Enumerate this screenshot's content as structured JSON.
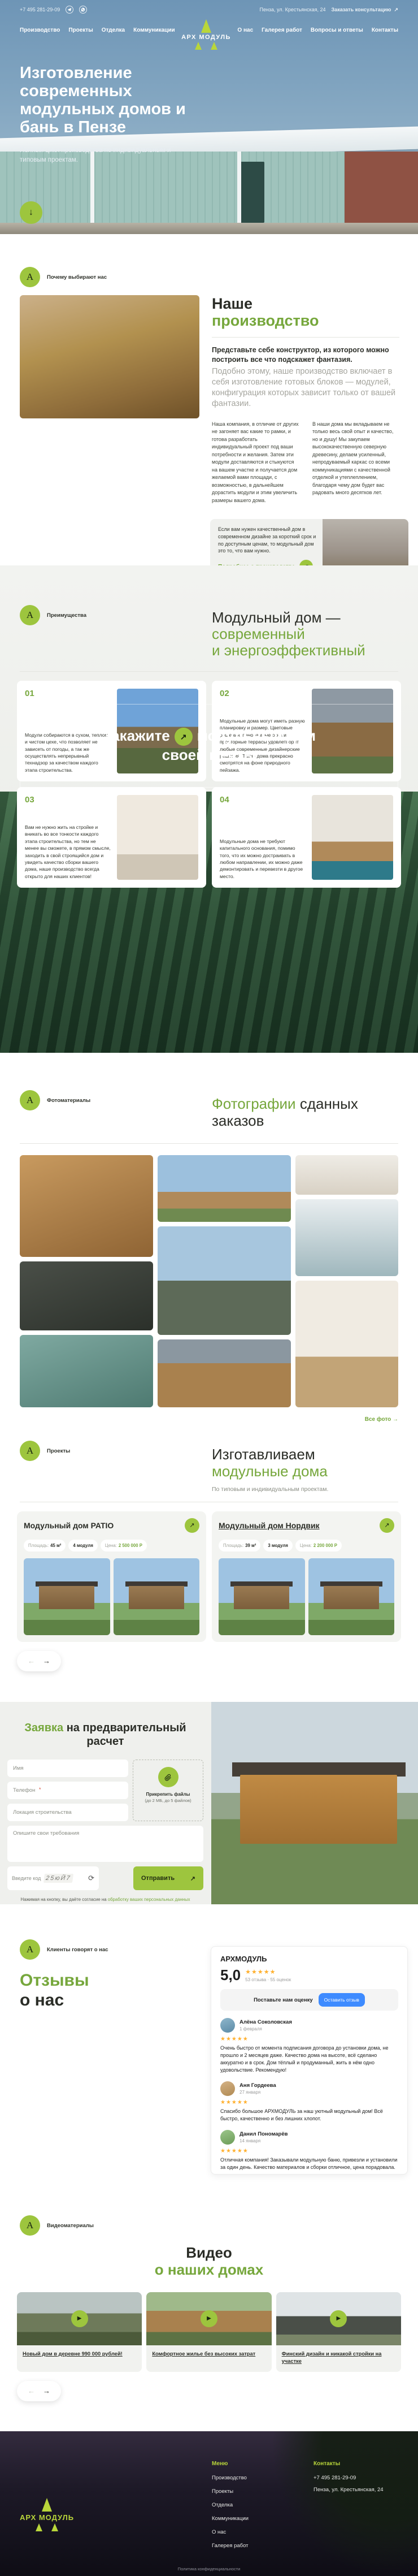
{
  "brand": {
    "name": "АРХ МОДУЛЬ",
    "mark": "А"
  },
  "icons": {
    "arrow_down": "↓",
    "arrow_up_right": "↗",
    "arrow_left": "←",
    "arrow_right": "→",
    "refresh": "⟳",
    "play": "▶"
  },
  "topbar": {
    "phone": "+7 495 281-29-09",
    "address": "Пенза, ул. Крестьянская, 24",
    "consult": "Заказать консультацию"
  },
  "nav": {
    "left": [
      {
        "label": "Производство"
      },
      {
        "label": "Проекты"
      },
      {
        "label": "Отделка"
      },
      {
        "label": "Коммуникации"
      }
    ],
    "right": [
      {
        "label": "О нас"
      },
      {
        "label": "Галерея работ"
      },
      {
        "label": "Вопросы и ответы"
      },
      {
        "label": "Контакты"
      }
    ]
  },
  "hero": {
    "title": "Изготовление современных модульных домов и бань в Пензе",
    "subtitle": "Полный цикл производства по индивидуальным и типовым проектам."
  },
  "production": {
    "label": "Почему выбирают нас",
    "heading_dark": "Наше",
    "heading_green": "производство",
    "lead_bold": "Представьте себе конструктор, из которого можно построить все что подскажет фантазия.",
    "lead_gray": "Подобно этому, наше производство включает в себя изготовление готовых блоков — модулей, конфигурация которых зависит только от вашей фантазии.",
    "col1": "Наша компания, в отличие от других не загоняет вас какие то рамки, и готова разработать индивидуальный проект под ваши потребности и желания. Затем эти модули доставляются и стыкуются на вашем участке и получается дом желаемой вами площади, с возможностью, в дальнейшем дорастить модули и этим увеличить размеры вашего дома.",
    "col2": "В наши дома мы вкладываем не только весь свой опыт и качество, но и душу! Мы закупаем высококачественную северную древесину, делаем усиленный, непродуваемый каркас со всеми коммуникациями с качественной отделкой и утеплеплением, благодаря чему дом будет вас радовать много десятков лет.",
    "card_text": "Если вам нужен качественный дом в современном дизайне за короткий срок и по доступным ценам, то модульный дом это то, что вам нужно.",
    "card_link": "Подробнее о производстве"
  },
  "advantages": {
    "label": "Преимущества",
    "heading_dark": "Модульный дом —",
    "heading_green_1": "современный",
    "heading_green_2": "и энергоэффективный",
    "items": [
      {
        "num": "01",
        "text": "Модули собираются в сухом, теплом и чистом цехе, что позволяет не зависеть от погоды, а так же осуществлять непрерывный технадзор за качеством каждого этапа строительства."
      },
      {
        "num": "02",
        "text": "Модульные дома могут иметь разную планировку и размер. Цветовые решения, панорамные окна и просторные террасы удовлетворят любые современные дизайнерские решения. Такие дома прекрасно смотрятся на фоне природного пейзажа."
      },
      {
        "num": "03",
        "text": "Вам не нужно жить на стройке и вникать во все тонкости каждого этапа строительства, но тем не менее вы сможете, в прямом смысле, заходить в свой строящийся дом и увидеть качество сборки вашего дома, наше производство всегда открыто для наших клиентов!"
      },
      {
        "num": "04",
        "text": "Модульные дома не требуют капитального основания, помимо того, что их можно достраивать в любом направлении, их можно даже демонтировать и перевезти в другое место."
      }
    ]
  },
  "banner": {
    "text_1": "Закажите",
    "text_2": "модульный дом своей мечты"
  },
  "gallery": {
    "label": "Фотоматериалы",
    "heading_green": "Фотографии",
    "heading_dark": "сданных заказов",
    "link": "Все фото"
  },
  "projects": {
    "label": "Проекты",
    "heading_dark": "Изготавливаем",
    "heading_green": "модульные дома",
    "subtitle": "По типовым и индивидуальным проектам.",
    "area_label": "Площадь:",
    "price_label": "Цена:",
    "cards": [
      {
        "title": "Модульный дом PATIO",
        "area": "45 м²",
        "modules": "4 модуля",
        "price": "2 500 000 Р"
      },
      {
        "title": "Модульный дом Нордвик",
        "area": "39 м²",
        "modules": "3 модуля",
        "price": "2 200 000 Р"
      }
    ]
  },
  "form": {
    "heading_green": "Заявка",
    "heading_dark": "на предварительный расчет",
    "name_placeholder": "Имя",
    "phone_placeholder": "Телефон",
    "phone_required_mark": "*",
    "location_placeholder": "Локация строительства",
    "message_placeholder": "Опишите свои требования",
    "captcha_label": "Введите код",
    "captcha_value": "25юЙ7",
    "attach_line1": "Прикрепить файлы",
    "attach_line2": "(до 2 МБ, до 5 файлов)",
    "submit": "Отправить",
    "consent_text": "Нажимая на кнопку, вы даёте согласие на",
    "consent_link": "обработку ваших персональных данных"
  },
  "reviews": {
    "label": "Клиенты говорят о нас",
    "heading_green": "Отзывы",
    "heading_dark": "о нас",
    "widget": {
      "org": "АРХМОДУЛЬ",
      "rating": "5,0",
      "stars": "★★★★★",
      "count": "53 отзыва · 55 оценок",
      "rate_prompt": "Поставьте нам оценку",
      "rate_button": "Оставить отзыв",
      "items": [
        {
          "name": "Алёна Соколовская",
          "date": "1 февраля",
          "stars": "★★★★★",
          "text": "Очень быстро от момента подписания договора до установки дома, не прошло и 2 месяцев даже. Качество дома на высоте, всё сделано аккуратно и в срок. Дом тёплый и продуманный, жить в нём одно удовольствие. Рекомендую!"
        },
        {
          "name": "Аня Гордеева",
          "date": "27 января",
          "stars": "★★★★★",
          "text": "Спасибо большое АРХМОДУЛЬ за наш уютный модульный дом! Всё быстро, качественно и без лишних хлопот."
        },
        {
          "name": "Данил Пономарёв",
          "date": "14 января",
          "stars": "★★★★★",
          "text": "Отличная компания! Заказывали модульную баню, привезли и установили за один день. Качество материалов и сборки отличное, цена порадовала."
        },
        {
          "name": "Дмитрий Соколов",
          "date": "28 декабря",
          "stars": "★★★★★",
          "text": "Долго выбирали производителя модульных домов и не ошиблись с выбором."
        }
      ]
    }
  },
  "video": {
    "label": "Видеоматериалы",
    "heading_dark": "Видео",
    "heading_green": "о наших домах",
    "cards": [
      {
        "caption": "Новый дом в деревне 990 000 рублей!"
      },
      {
        "caption": "Комфортное жилье без высоких затрат"
      },
      {
        "caption": "Финский дизайн и никакой стройки на участке"
      }
    ]
  },
  "footer": {
    "menu_title": "Меню",
    "menu": [
      "Производство",
      "Проекты",
      "Отделка",
      "Коммуникации",
      "О нас",
      "Галерея работ"
    ],
    "contacts_title": "Контакты",
    "phone": "+7 495 281-29-09",
    "address": "Пенза, ул. Крестьянская, 24",
    "bottom": "Политика конфиденциальности"
  }
}
